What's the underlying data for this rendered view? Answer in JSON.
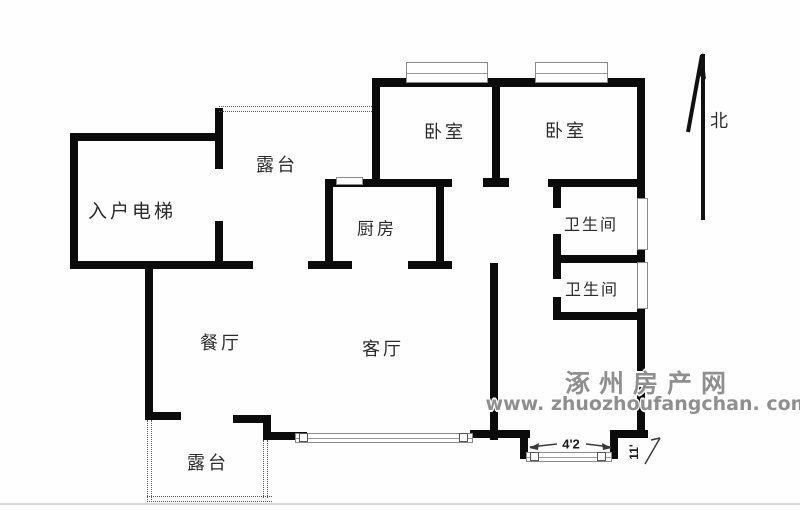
{
  "plan": {
    "rooms": [
      {
        "id": "entry-elevator",
        "label": "入户电梯"
      },
      {
        "id": "terrace-upper",
        "label": "露台"
      },
      {
        "id": "bedroom-1",
        "label": "卧室"
      },
      {
        "id": "bedroom-2",
        "label": "卧室"
      },
      {
        "id": "kitchen",
        "label": "厨房"
      },
      {
        "id": "bathroom-1",
        "label": "卫生间"
      },
      {
        "id": "bathroom-2",
        "label": "卫生间"
      },
      {
        "id": "dining-room",
        "label": "餐厅"
      },
      {
        "id": "living-room",
        "label": "客厅"
      },
      {
        "id": "terrace-lower",
        "label": "露台"
      }
    ],
    "compass": {
      "north_label": "北"
    },
    "dimensions": {
      "bay_width": "4'2",
      "bay_depth": "11'"
    }
  },
  "watermark": {
    "site_name": "涿州房产网",
    "site_url": "www. zhuozhoufangchan. com"
  },
  "colors": {
    "wall": "#0b0b0b",
    "window_outline": "#8a8a8a",
    "watermark_text": "#8f8f8f",
    "label_text": "#2b2b2b"
  }
}
